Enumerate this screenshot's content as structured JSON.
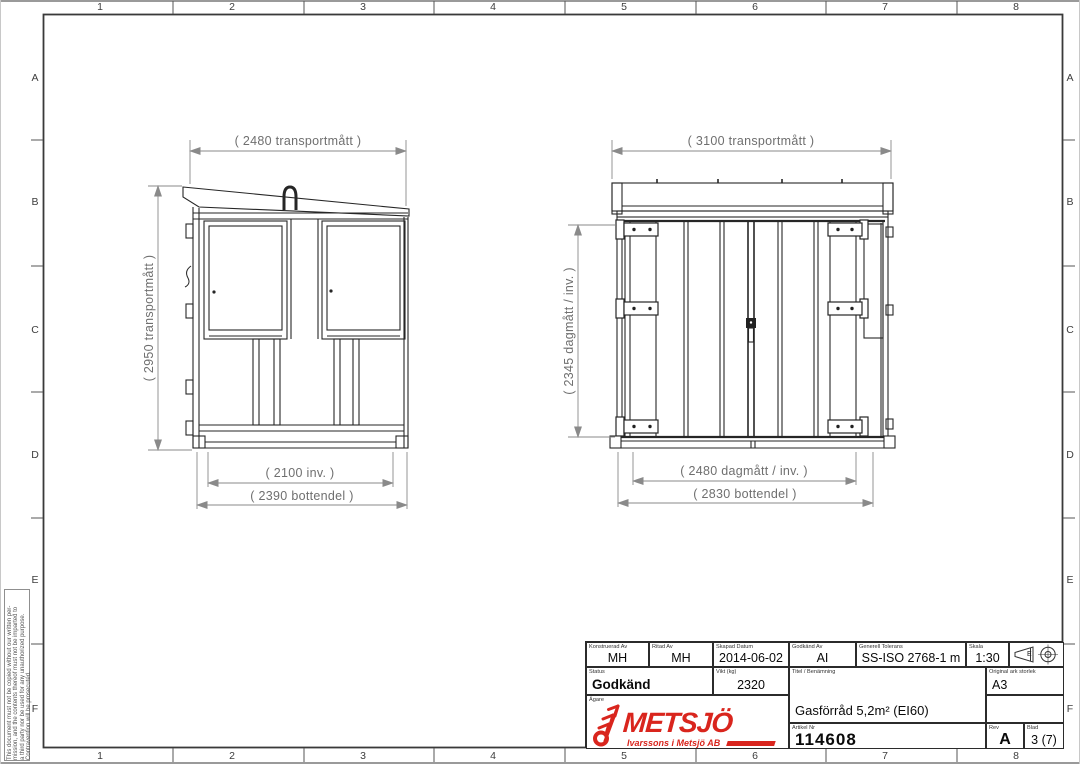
{
  "sheet": {
    "cols": [
      "1",
      "2",
      "3",
      "4",
      "5",
      "6",
      "7",
      "8"
    ],
    "rows": [
      "A",
      "B",
      "C",
      "D",
      "E",
      "F"
    ],
    "copyright": [
      "This document must not be copied without our written per-",
      "mission, and the contents thereof must not be imparted to",
      "a third party nor be used for any unauthorized purpose.",
      "Contravention will be prosecuted."
    ]
  },
  "views": {
    "side": {
      "dim_top": "( 2480 transportmått )",
      "dim_height": "( 2950 transportmått )",
      "dim_inner_width": "( 2100 inv. )",
      "dim_bottom": "( 2390 bottendel )"
    },
    "front": {
      "dim_top": "( 3100 transportmått )",
      "dim_height": "( 2345 dagmått / inv. )",
      "dim_inner_width": "( 2480 dagmått / inv. )",
      "dim_bottom": "( 2830 bottendel )"
    }
  },
  "title_block": {
    "konstruerad_label": "Konstruerad Av",
    "konstruerad": "MH",
    "ritad_label": "Ritad Av",
    "ritad": "MH",
    "skapad_label": "Skapad Datum",
    "skapad": "2014-06-02",
    "godkand_av_label": "Godkänd Av",
    "godkand_av": "AI",
    "tolerans_label": "Generell Tolerans",
    "tolerans": "SS-ISO 2768-1 m",
    "skala_label": "Skala",
    "skala": "1:30",
    "status_label": "Status",
    "status": "Godkänd",
    "vikt_label": "Vikt (kg)",
    "vikt": "2320",
    "titel_label": "Titel / Benämning",
    "titel": "Gasförråd 5,2m² (EI60)",
    "ark_label": "Original ark storlek",
    "ark": "A3",
    "agare_label": "Ägare",
    "artikel_label": "Artikel Nr",
    "artikel": "114608",
    "rev_label": "Rev",
    "rev": "A",
    "blad_label": "Blad",
    "blad": "3 (7)",
    "projection_letter": "E"
  },
  "logo": {
    "name": "METSJÖ",
    "tagline": "Ivarssons i Metsjö AB"
  },
  "colors": {
    "logo_red": "#d9251d",
    "line": "#262626",
    "dim": "#8a8a8a"
  }
}
